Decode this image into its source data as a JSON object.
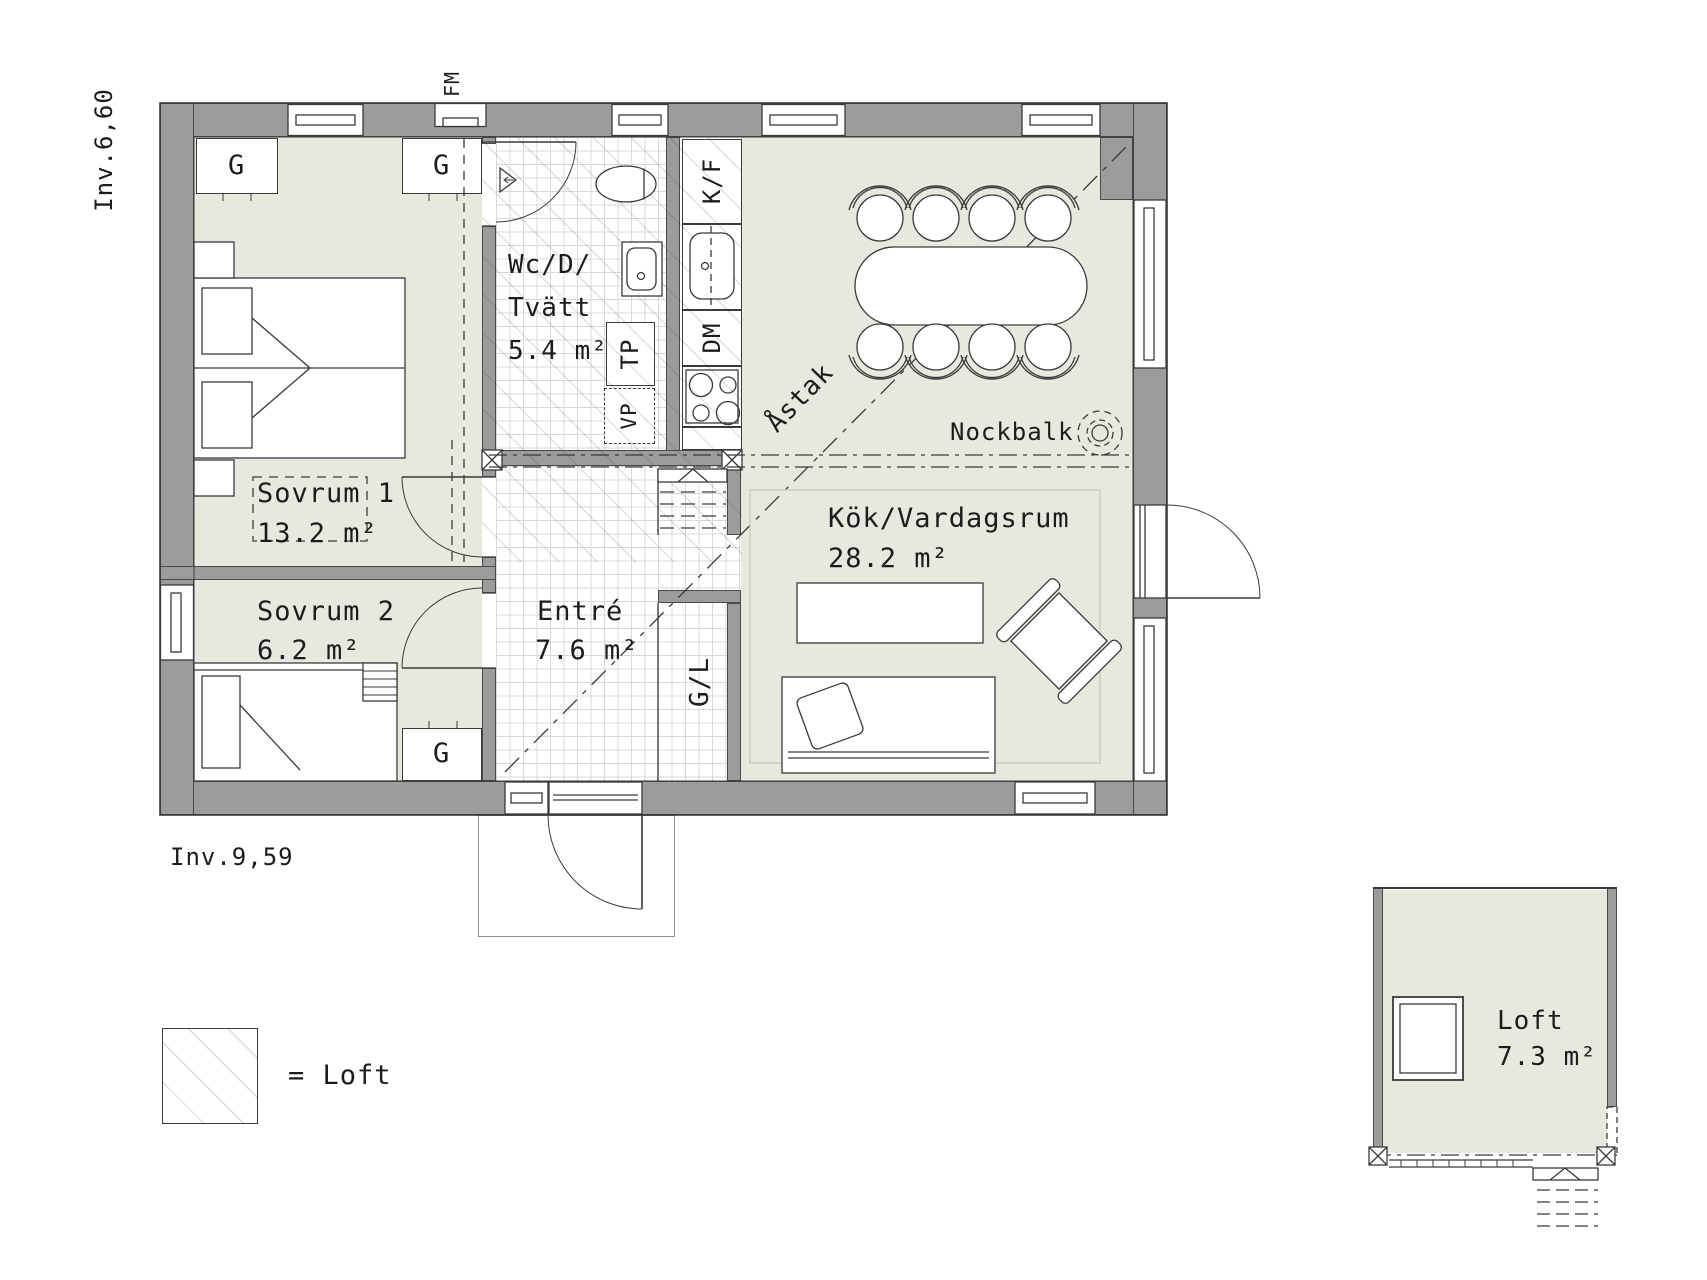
{
  "rooms": {
    "sovrum1": {
      "name": "Sovrum 1",
      "area": "13.2 m²"
    },
    "sovrum2": {
      "name": "Sovrum 2",
      "area": "6.2 m²"
    },
    "wc": {
      "line1": "Wc/D/",
      "line2": "Tvätt",
      "area": "5.4 m²"
    },
    "entre": {
      "name": "Entré",
      "area": "7.6 m²"
    },
    "kitchen_living": {
      "name": "Kök/Vardagsrum",
      "area": "28.2 m²"
    },
    "loft": {
      "name": "Loft",
      "area": "7.3 m²"
    }
  },
  "fixtures": {
    "wardrobe": "G",
    "wardrobe_linen": "G/L",
    "fridge_freezer": "K/F",
    "dishwasher": "DM",
    "dryer_tower": "TP",
    "heat_pump": "VP"
  },
  "annotations": {
    "fresh_air_vent": "FM",
    "ridge_line": "Åstak",
    "ridge_beam": "Nockbalk",
    "interior_width": "Inv.6,60",
    "interior_length": "Inv.9,59",
    "legend_loft": "= Loft"
  },
  "colors": {
    "wall": "#9c9c9a",
    "floor": "#e9e8df",
    "line": "#3a3a3a"
  }
}
